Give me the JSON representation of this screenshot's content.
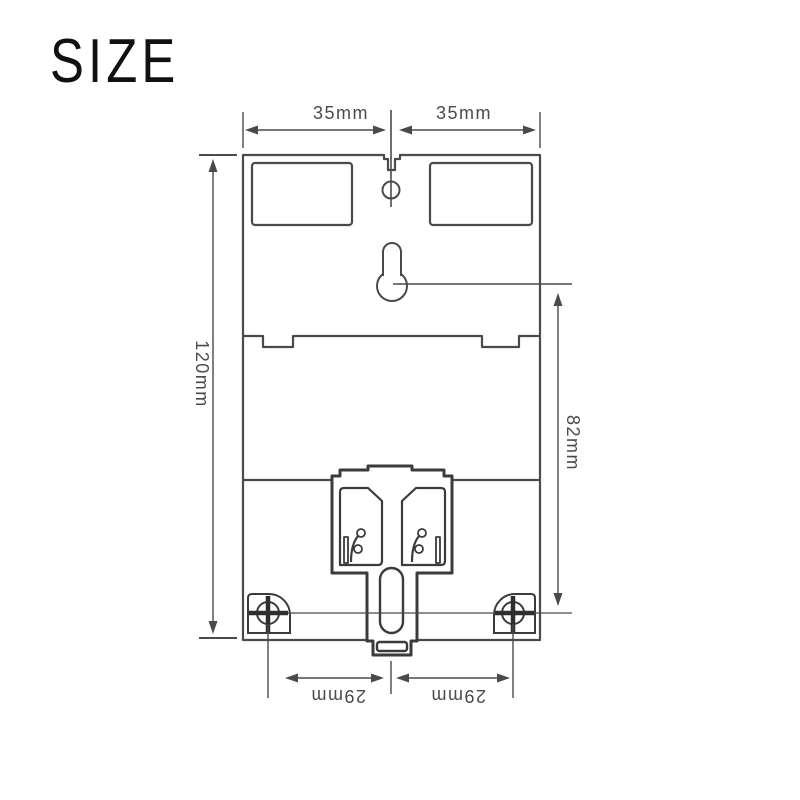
{
  "title": "SIZE",
  "colors": {
    "background": "#ffffff",
    "line": "#4a4a4a",
    "thick_line": "#3b3b3b",
    "crosshair": "#2e2e2e",
    "text": "#4a4a4a",
    "title_text": "#111111"
  },
  "diagram": {
    "parts": [
      "enclosure-rear-outline",
      "terminal-cover-left",
      "terminal-cover-right",
      "hanger-hole",
      "mounting-keyhole",
      "din-rail-clip",
      "clip-spring-windows",
      "clip-slider-slot",
      "screw-hole-bottom-left",
      "screw-hole-bottom-right"
    ],
    "dimensions": {
      "top_left": "35mm",
      "top_right": "35mm",
      "height": "120mm",
      "right": "82mm",
      "bottom_left": "29mm",
      "bottom_right": "29mm"
    }
  }
}
